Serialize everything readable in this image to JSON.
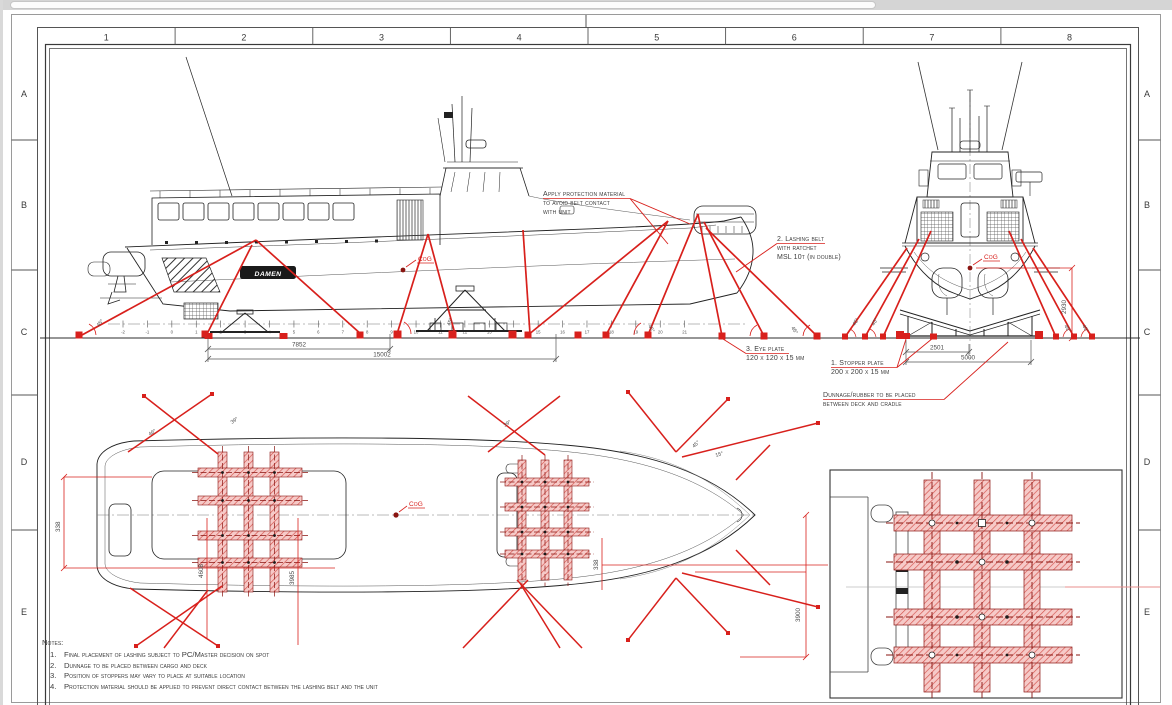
{
  "sheet": {
    "columns": [
      "1",
      "2",
      "3",
      "4",
      "5",
      "6",
      "7",
      "8"
    ],
    "rows": [
      "A",
      "B",
      "C",
      "D",
      "E"
    ]
  },
  "brand": "DAMEN",
  "labels": {
    "cog": "CoG",
    "protection_1": "Apply protection material",
    "protection_2": "to avoid belt contact",
    "protection_3": "with unit",
    "lashing_1": "2. Lashing belt",
    "lashing_2": "with ratchet",
    "lashing_3": "MSL 10t (in double)",
    "eye_plate_1": "3. Eye plate",
    "eye_plate_2": "120 x 120 x 15 mm",
    "stopper_1": "1. Stopper plate",
    "stopper_2": "200 x 200 x 15 mm",
    "dunnage_1": "Dunnage/rubber to be placed",
    "dunnage_2": "between deck and cradle"
  },
  "dimensions": {
    "side_inner": "7852",
    "side_outer": "15002",
    "front_inner": "2501",
    "front_outer": "5000",
    "front_height": "2930",
    "plan_left": "338",
    "plan_right": "338",
    "plan_len1": "4608",
    "plan_len2": "3985",
    "plan_bow": "3900"
  },
  "angles": {
    "side_1": "45°",
    "side_2": "45°",
    "side_3": "45°",
    "side_4": "45°",
    "front_1": "45°",
    "front_2": "45°",
    "front_3": "45°",
    "front_4": "45°",
    "plan_stern": "46°",
    "plan_mid1": "39°",
    "plan_mid2": "39°",
    "plan_bow1": "45°",
    "plan_bow2": "15°"
  },
  "stations": [
    "-2",
    "-1",
    "0",
    "1",
    "2",
    "3",
    "4",
    "5",
    "6",
    "7",
    "8",
    "9",
    "10",
    "11",
    "12",
    "13",
    "14",
    "15",
    "16",
    "17",
    "18",
    "19",
    "20",
    "21"
  ],
  "notes": {
    "title": "Notes:",
    "items": [
      {
        "num": "1.",
        "text": "Final placement of lashing subject to PC/Master decision on spot"
      },
      {
        "num": "2.",
        "text": "Dunnage to be placed between cargo and deck"
      },
      {
        "num": "3.",
        "text": "Position of stoppers may vary to place at suitable location"
      },
      {
        "num": "4.",
        "text": "Protection material should be applied to prevent direct contact between the lashing belt and the unit"
      }
    ]
  },
  "colors": {
    "accent_red": "#d8201c",
    "dark_red": "#8a1511",
    "line": "#2d2d2d",
    "hatch_fill": "#f6cac8"
  }
}
